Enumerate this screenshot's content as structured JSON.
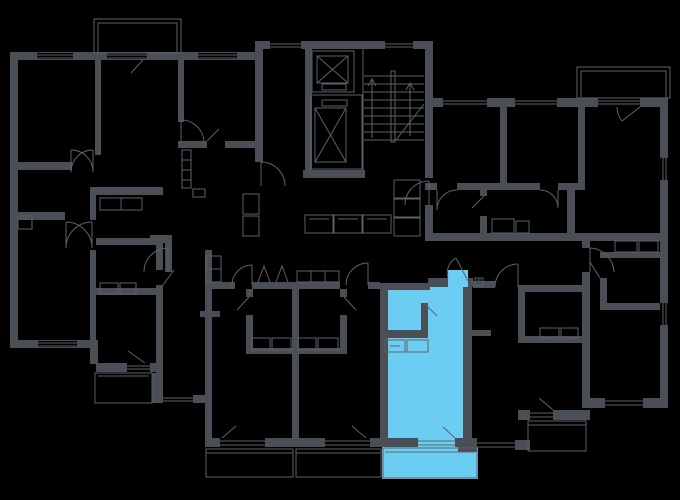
{
  "app": {
    "title": "Building floor plan with selected apartment highlighted"
  },
  "colors": {
    "background": "#000000",
    "wall": "#4a4f55",
    "wall_thin": "#5d6267",
    "highlight": "#6ccdf3"
  },
  "plan": {
    "type": "residential-floor-plan",
    "highlighted_unit": {
      "name": "studio-apartment-bottom-center",
      "state": "selected",
      "rooms": [
        "bathroom",
        "kitchen-living-room",
        "balcony"
      ]
    },
    "units": [
      {
        "name": "apartment-top-left",
        "highlighted": false
      },
      {
        "name": "apartment-bottom-left",
        "highlighted": false
      },
      {
        "name": "unit-bottom-center-left",
        "highlighted": false
      },
      {
        "name": "unit-bottom-center-right",
        "highlighted": false
      },
      {
        "name": "studio-apartment-bottom-center",
        "highlighted": true
      },
      {
        "name": "apartment-middle-right",
        "highlighted": false
      },
      {
        "name": "apartment-top-right",
        "highlighted": false
      },
      {
        "name": "studio-apartment-right",
        "highlighted": false
      }
    ],
    "core": [
      "elevator-shaft-small",
      "elevator-shaft-large",
      "staircase",
      "lobby-mailboxes"
    ],
    "balconies": [
      "balcony-top-left",
      "balcony-top-right",
      "balcony-left-stepped",
      "balcony-bottom-center-left",
      "balcony-bottom-center-right",
      "balcony-highlighted-unit",
      "balcony-middle-right"
    ]
  }
}
